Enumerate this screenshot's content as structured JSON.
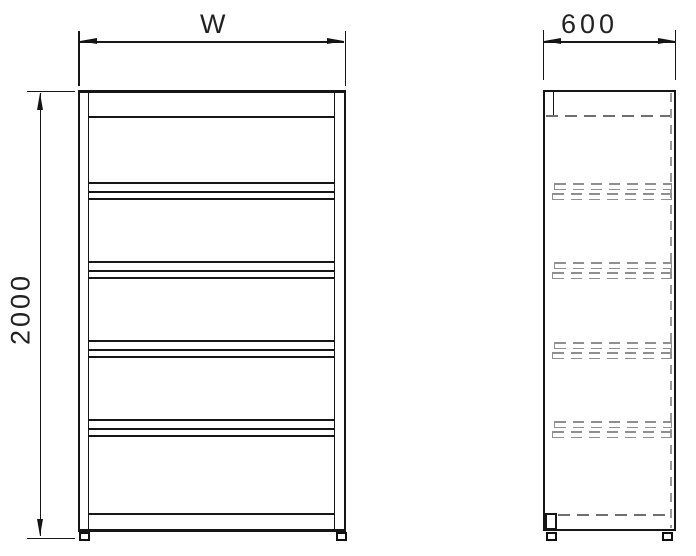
{
  "drawing": {
    "type": "technical drawing - shelving unit, front and side elevation views",
    "dimensions": {
      "width": {
        "label": "W"
      },
      "depth": {
        "label": "600"
      },
      "height": {
        "label": "2000"
      }
    },
    "views": {
      "front": {
        "shelf_levels": 6,
        "posts": 2,
        "feet": 2
      },
      "side": {
        "shelf_support_groups": 4,
        "hidden_lines": true,
        "feet": 2
      }
    },
    "colors": {
      "line": "#161616",
      "hidden_line": "#6f6f6f",
      "support_dash": "#8f8f8f",
      "background": "#ffffff"
    }
  }
}
